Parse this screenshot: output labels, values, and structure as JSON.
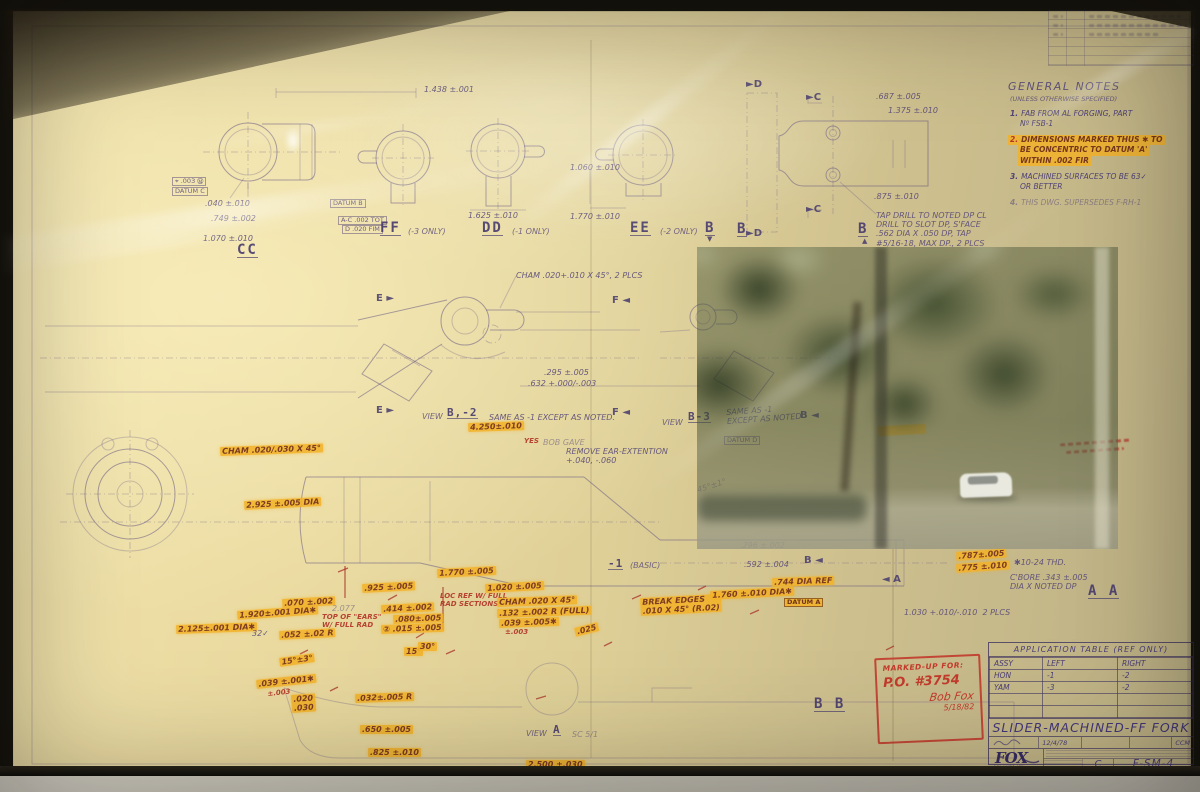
{
  "photo": {
    "description": "Framed FOX engineering drawing behind glass with window reflection",
    "paper_color": "#e9d99f",
    "highlight_color": "#f3b228",
    "red_ink_color": "#c23b2c",
    "pencil_color": "#564878"
  },
  "general_notes": {
    "title": "GENERAL NOTES",
    "subtitle": "(UNLESS OTHERWISE SPECIFIED)",
    "items": [
      {
        "num": "1.",
        "lines": [
          "FAB FROM AL FORGING, PART",
          "Nº FSB-1"
        ],
        "hl": false,
        "red": false,
        "faint": false
      },
      {
        "num": "2.",
        "lines": [
          "DIMENSIONS MARKED THUS ✱ TO",
          "BE CONCENTRIC TO DATUM 'A'",
          "WITHIN .002 FIR"
        ],
        "hl": true,
        "red": true,
        "faint": false
      },
      {
        "num": "3.",
        "lines": [
          "MACHINED SURFACES TO BE 63✓",
          "OR BETTER"
        ],
        "hl": false,
        "red": false,
        "faint": false
      },
      {
        "num": "4.",
        "lines": [
          "THIS DWG. SUPERSEDES F-RH-1"
        ],
        "hl": false,
        "red": false,
        "faint": true
      }
    ]
  },
  "stamp": {
    "line1": "MARKED-UP FOR:",
    "po": "P.O. #3754",
    "signature": "Bob Fox",
    "date": "5/18/82"
  },
  "application_table": {
    "title": "APPLICATION TABLE (REF ONLY)",
    "headers": [
      "ASSY",
      "LEFT",
      "RIGHT"
    ],
    "rows": [
      [
        "HON",
        "-1",
        "-2"
      ],
      [
        "YAM",
        "-3",
        "-2"
      ],
      [
        "",
        "",
        ""
      ],
      [
        "",
        "",
        ""
      ]
    ]
  },
  "title_block": {
    "title": "SLIDER-MACHINED-FF FORK",
    "date": "12/4/78",
    "approved": "CCM",
    "logo": "FOX",
    "logo_sub": "FACTORY INC.",
    "rev": "C",
    "dwg_no": "F-SM-4"
  },
  "annotations": [
    {
      "t": "1.438 ±.001",
      "x": 424,
      "y": 85,
      "c": "d"
    },
    {
      "t": "⌖ .003 Ⓜ",
      "x": 172,
      "y": 177,
      "c": "b"
    },
    {
      "t": "DATUM C",
      "x": 172,
      "y": 187,
      "c": "b"
    },
    {
      "t": ".040 ±.010",
      "x": 205,
      "y": 199,
      "c": "d"
    },
    {
      "t": ".749 ±.002",
      "x": 211,
      "y": 214,
      "c": "d"
    },
    {
      "t": "1.070 ±.010",
      "x": 203,
      "y": 234,
      "c": "d"
    },
    {
      "t": "CC",
      "x": 237,
      "y": 243,
      "c": "s"
    },
    {
      "t": "DATUM B",
      "x": 330,
      "y": 199,
      "c": "b"
    },
    {
      "t": "A-C .002 TOT",
      "x": 338,
      "y": 216,
      "c": "b"
    },
    {
      "t": "D .020 FIM",
      "x": 342,
      "y": 225,
      "c": "b"
    },
    {
      "t": "FF",
      "x": 380,
      "y": 221,
      "c": "s"
    },
    {
      "t": "(-3 ONLY)",
      "x": 408,
      "y": 227,
      "c": "v"
    },
    {
      "t": "1.625 ±.010",
      "x": 468,
      "y": 211,
      "c": "d"
    },
    {
      "t": "DD",
      "x": 482,
      "y": 221,
      "c": "s"
    },
    {
      "t": "(-1 ONLY)",
      "x": 512,
      "y": 227,
      "c": "v"
    },
    {
      "t": "1.060 ±.010",
      "x": 570,
      "y": 163,
      "c": "d"
    },
    {
      "t": "1.770 ±.010",
      "x": 570,
      "y": 212,
      "c": "d"
    },
    {
      "t": "EE",
      "x": 630,
      "y": 221,
      "c": "s"
    },
    {
      "t": "(-2 ONLY)",
      "x": 660,
      "y": 227,
      "c": "v"
    },
    {
      "t": "B",
      "x": 705,
      "y": 221,
      "c": "s"
    },
    {
      "t": "▼",
      "x": 707,
      "y": 236,
      "c": "fa"
    },
    {
      "t": "►D",
      "x": 746,
      "y": 80,
      "c": "f"
    },
    {
      "t": "►D",
      "x": 746,
      "y": 229,
      "c": "f"
    },
    {
      "t": "►C",
      "x": 806,
      "y": 93,
      "c": "f"
    },
    {
      "t": "►C",
      "x": 806,
      "y": 205,
      "c": "f"
    },
    {
      "t": ".687 ±.005",
      "x": 876,
      "y": 92,
      "c": "d"
    },
    {
      "t": "1.375 ±.010",
      "x": 888,
      "y": 106,
      "c": "d"
    },
    {
      "t": ".875 ±.010",
      "x": 874,
      "y": 192,
      "c": "d"
    },
    {
      "t": "TAP DRILL TO NOTED DP CL\nDRILL TO SLOT DP, S'FACE\n.562 DIA X .050 DP, TAP\n#5/16-18, MAX DP., 2 PLCS",
      "x": 876,
      "y": 211,
      "c": "d"
    },
    {
      "t": "B",
      "x": 737,
      "y": 222,
      "c": "s"
    },
    {
      "t": "B",
      "x": 858,
      "y": 222,
      "c": "s"
    },
    {
      "t": "▲",
      "x": 862,
      "y": 238,
      "c": "fa"
    },
    {
      "t": "CHAM .020+.010 X 45°, 2 PLCS",
      "x": 516,
      "y": 271,
      "c": "d"
    },
    {
      "t": "E ►",
      "x": 376,
      "y": 294,
      "c": "f"
    },
    {
      "t": "E ►",
      "x": 376,
      "y": 406,
      "c": "f"
    },
    {
      "t": "F ◄",
      "x": 612,
      "y": 296,
      "c": "f"
    },
    {
      "t": "F ◄",
      "x": 612,
      "y": 408,
      "c": "f"
    },
    {
      "t": ".295 ±.005",
      "x": 544,
      "y": 368,
      "c": "d"
    },
    {
      "t": ".632 +.000/-.003",
      "x": 528,
      "y": 379,
      "c": "d"
    },
    {
      "t": "VIEW",
      "x": 422,
      "y": 412,
      "c": "v"
    },
    {
      "t": "B,-2",
      "x": 447,
      "y": 407,
      "c": "ss"
    },
    {
      "t": "SAME AS -1 EXCEPT AS NOTED.",
      "x": 489,
      "y": 413,
      "c": "d"
    },
    {
      "t": "4.250±.010",
      "x": 468,
      "y": 423,
      "c": "h",
      "r": -2
    },
    {
      "t": "YES",
      "x": 524,
      "y": 437,
      "c": "r"
    },
    {
      "t": "BOB GAVE",
      "x": 543,
      "y": 438,
      "c": "df"
    },
    {
      "t": "VIEW",
      "x": 662,
      "y": 418,
      "c": "v"
    },
    {
      "t": "B-3",
      "x": 688,
      "y": 411,
      "c": "ss"
    },
    {
      "t": "SAME AS -1\nEXCEPT AS NOTED",
      "x": 726,
      "y": 408,
      "c": "d",
      "r": -4
    },
    {
      "t": "B ◄",
      "x": 800,
      "y": 411,
      "c": "f"
    },
    {
      "t": "DATUM D",
      "x": 724,
      "y": 436,
      "c": "b"
    },
    {
      "t": "REMOVE EAR-EXTENTION\n+.040, -.060",
      "x": 566,
      "y": 447,
      "c": "d"
    },
    {
      "t": "45°±1°",
      "x": 696,
      "y": 486,
      "c": "df",
      "r": -18
    },
    {
      "t": "CHAM .020/.030 X 45°",
      "x": 220,
      "y": 447,
      "c": "h",
      "r": -2
    },
    {
      "t": "2.925 ±.005 DIA",
      "x": 244,
      "y": 501,
      "c": "h",
      "r": -3
    },
    {
      "t": "2.125±.001 DIA✱",
      "x": 176,
      "y": 625,
      "c": "h",
      "r": -2
    },
    {
      "t": "1.920±.001 DIA✱",
      "x": 237,
      "y": 611,
      "c": "h",
      "r": -4
    },
    {
      "t": ".070 ±.002",
      "x": 282,
      "y": 599,
      "c": "h",
      "r": -3
    },
    {
      "t": "32✓",
      "x": 252,
      "y": 629,
      "c": "d"
    },
    {
      "t": ".052 ±.02 R",
      "x": 279,
      "y": 631,
      "c": "h",
      "r": -3
    },
    {
      "t": "15°±3°",
      "x": 279,
      "y": 658,
      "c": "h",
      "r": -8
    },
    {
      "t": ".039 ±.001✱",
      "x": 256,
      "y": 680,
      "c": "h",
      "r": -6
    },
    {
      "t": "±.003",
      "x": 267,
      "y": 690,
      "c": "r",
      "r": -6
    },
    {
      "t": ".020\n.030",
      "x": 291,
      "y": 695,
      "c": "h",
      "r": -4
    },
    {
      "t": ".032±.005 R",
      "x": 355,
      "y": 694,
      "c": "h",
      "r": -2
    },
    {
      "t": "2.077",
      "x": 332,
      "y": 604,
      "c": "df"
    },
    {
      "t": "TOP OF \"EARS\"\nW/ FULL RAD",
      "x": 322,
      "y": 613,
      "c": "r"
    },
    {
      "t": ".925 ±.005",
      "x": 362,
      "y": 584,
      "c": "h",
      "r": -3
    },
    {
      "t": ".414 ±.002",
      "x": 381,
      "y": 605,
      "c": "h",
      "r": -3
    },
    {
      "t": ".080±.005",
      "x": 393,
      "y": 615,
      "c": "h",
      "r": -2
    },
    {
      "t": "② .015 ±.005",
      "x": 381,
      "y": 625,
      "c": "h",
      "r": -2
    },
    {
      "t": "15°",
      "x": 404,
      "y": 647,
      "c": "h"
    },
    {
      "t": "30°",
      "x": 418,
      "y": 642,
      "c": "h"
    },
    {
      "t": "1.770 ±.005",
      "x": 437,
      "y": 569,
      "c": "h",
      "r": -3
    },
    {
      "t": "LOC REF W/ FULL\nRAD SECTIONS",
      "x": 440,
      "y": 592,
      "c": "r"
    },
    {
      "t": "1.020 ±.005",
      "x": 485,
      "y": 584,
      "c": "h",
      "r": -3
    },
    {
      "t": "CHAM .020 X 45°",
      "x": 497,
      "y": 598,
      "c": "h",
      "r": -2
    },
    {
      "t": ".132 ±.002 R (FULL)",
      "x": 497,
      "y": 609,
      "c": "h",
      "r": -2
    },
    {
      "t": ".039 ±.005✱",
      "x": 499,
      "y": 619,
      "c": "h",
      "r": -2
    },
    {
      "t": "±.003",
      "x": 505,
      "y": 628,
      "c": "r"
    },
    {
      "t": ".025",
      "x": 574,
      "y": 628,
      "c": "h",
      "r": -14
    },
    {
      "t": "-1",
      "x": 608,
      "y": 558,
      "c": "ss"
    },
    {
      "t": "(BASIC)",
      "x": 630,
      "y": 561,
      "c": "v"
    },
    {
      "t": ".296 ±.002",
      "x": 740,
      "y": 541,
      "c": "df"
    },
    {
      "t": ".592 ±.004",
      "x": 744,
      "y": 560,
      "c": "d"
    },
    {
      "t": "BREAK EDGES\n.010 X 45° (R.02)",
      "x": 640,
      "y": 598,
      "c": "h",
      "r": -3
    },
    {
      "t": "1.760 ±.010 DIA✱",
      "x": 710,
      "y": 591,
      "c": "h",
      "r": -3
    },
    {
      "t": ".744 DIA REF",
      "x": 772,
      "y": 578,
      "c": "h",
      "r": -2
    },
    {
      "t": "DATUM A",
      "x": 784,
      "y": 598,
      "c": "bh"
    },
    {
      "t": "B ◄",
      "x": 804,
      "y": 556,
      "c": "f"
    },
    {
      "t": "◄ A",
      "x": 882,
      "y": 575,
      "c": "f"
    },
    {
      "t": ".787±.005",
      "x": 956,
      "y": 552,
      "c": "h",
      "r": -4
    },
    {
      "t": ".775 ±.010",
      "x": 956,
      "y": 564,
      "c": "h",
      "r": -4
    },
    {
      "t": "✱10-24 THD.",
      "x": 1014,
      "y": 558,
      "c": "d"
    },
    {
      "t": "C'BORE .343 ±.005\nDIA X NOTED DP",
      "x": 1010,
      "y": 573,
      "c": "d"
    },
    {
      "t": "A A",
      "x": 1088,
      "y": 584,
      "c": "s"
    },
    {
      "t": "1.030 +.010/-.010  2 PLCS",
      "x": 904,
      "y": 608,
      "c": "d"
    },
    {
      "t": "B B",
      "x": 814,
      "y": 697,
      "c": "s"
    },
    {
      "t": ".650 ±.005",
      "x": 360,
      "y": 725,
      "c": "h"
    },
    {
      "t": ".825 ±.010",
      "x": 368,
      "y": 748,
      "c": "h"
    },
    {
      "t": "VIEW",
      "x": 526,
      "y": 729,
      "c": "v"
    },
    {
      "t": "A",
      "x": 553,
      "y": 724,
      "c": "ss"
    },
    {
      "t": "SC 5/1",
      "x": 572,
      "y": 730,
      "c": "df"
    },
    {
      "t": "2.500 ±.030",
      "x": 526,
      "y": 760,
      "c": "h"
    }
  ]
}
